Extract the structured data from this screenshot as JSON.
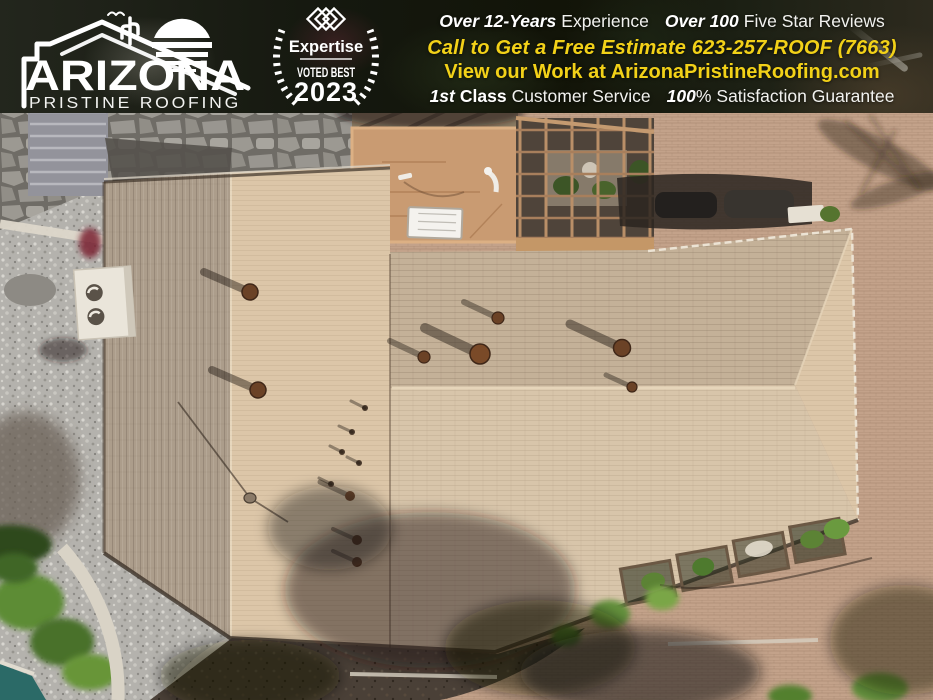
{
  "header": {
    "logo": {
      "title": "ARIZONA",
      "subtitle": "PRISTINE ROOFING"
    },
    "badge": {
      "brand": "Expertise",
      "voted_best": "VOTED BEST",
      "year": "2023"
    },
    "line1": {
      "bold1": "Over 12-Years",
      "text1": "Experience",
      "bold2": "Over 100",
      "text2": "Five Star Reviews"
    },
    "line2": {
      "text": "Call to Get a Free Estimate 623-257-ROOF (7663)"
    },
    "line3": {
      "text": "View our Work at ArizonaPristineRoofing.com"
    },
    "line4": {
      "bold1": "1st",
      "semi1": "Class",
      "text1": "Customer Service",
      "bold2": "100",
      "pct": "%",
      "text2": "Satisfaction Guarantee"
    },
    "colors": {
      "accent_yellow": "#F2D118",
      "text_white": "#FFFFFF"
    }
  },
  "photo": {
    "scene": "aerial drone view of tan shingle hip roof, flat patio roof with pergola, gravel yard left, paver driveway right, tree shadows bottom",
    "colors": {
      "shingle_south": "#D8C5AA",
      "shingle_north": "#C4B198",
      "shingle_west": "#AC9D8B",
      "shingle_east": "#DCC6A8",
      "flat_roof_tan": "#C99B72",
      "driveway_pavers": "#BF9D84",
      "gravel": "#B4B2AD",
      "flagstone": "#8F8C86",
      "vegetation": "#5D8C35",
      "shadow": "#2A211A",
      "pool": "#2B6A67",
      "wall_white": "#E8E3D7",
      "vent_brown": "#6B4226"
    }
  }
}
